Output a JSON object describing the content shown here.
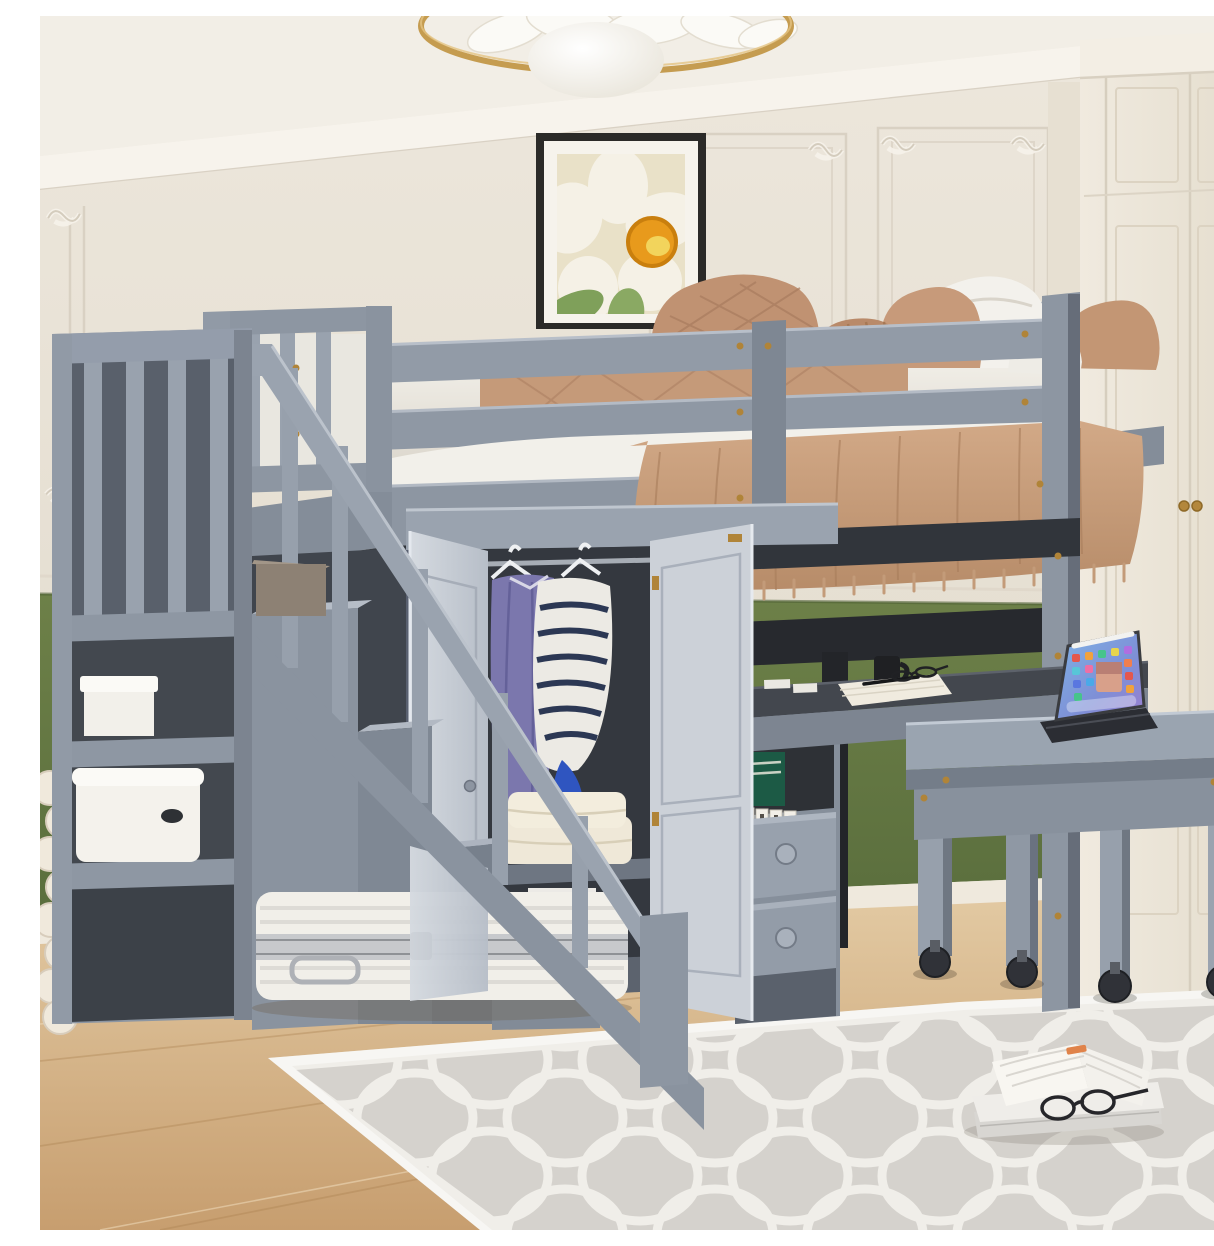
{
  "image": {
    "kind": "furniture product photograph",
    "subject": "Gray loft bed with storage staircase, open wardrobe, shelves, drawers, built-in desk and rolling desk in a bedroom",
    "setting": "bedroom with cream paneled walls, olive-green wainscot, white built-in closet, gold ring chandelier, light oak floor and gray quatrefoil trellis rug"
  },
  "palette": {
    "ceiling": "#f2eee6",
    "wall_cream": "#e9e3d7",
    "panel_molding": "#d9d1c3",
    "wainscot_green": "#64783f",
    "closet_cream": "#ece6da",
    "floor_wood": "#d7b98f",
    "rug_gray": "#d5d2cd",
    "rug_white": "#f0eee9",
    "bed_gray": "#8d96a2",
    "bed_gray_light": "#c9ced6",
    "bed_gray_dark": "#4a505a",
    "desk_top_dark": "#43474e",
    "metal_black": "#26282c",
    "brass": "#b08438",
    "bedding_white": "#f2f0ea",
    "pillow_tan": "#c49a7a",
    "throw_tan": "#c9a083",
    "art_flower_orange": "#e89a1c",
    "leaf_green": "#7fa05a",
    "garment_purple": "#7b77ad",
    "sweater_stripe_navy": "#2c3854",
    "sweater_cuff_blue": "#2f55c0",
    "hatbox_beige": "#e3d7ae",
    "tablet_screen_blue": "#6d9ddf"
  },
  "objects": {
    "ceiling_lamp": {
      "parts": [
        "gold ring",
        "white petals",
        "white globe"
      ]
    },
    "wall_art": {
      "desc": "black framed painting of a white flower with orange center and green leaves"
    },
    "loft_bed": {
      "desc": "gray wood loft bed with double guardrails, slat panels and posts",
      "bedding": [
        "white sheets",
        "tan quilted pillows",
        "white pillows",
        "fringed camel throw"
      ]
    },
    "staircase": {
      "desc": "storage staircase with handrail, balusters, side shelves",
      "items": [
        "white gift box",
        "white storage bin",
        "taupe box on step",
        "white suitcase on floor"
      ]
    },
    "wardrobe": {
      "desc": "open double-door wardrobe under bed",
      "items": [
        "purple top on hanger",
        "navy striped sweater on hanger",
        "folded cream blankets",
        "white box",
        "round beige hatbox",
        "gray box"
      ]
    },
    "shelf_column": {
      "desc": "cubby with green box and letter tiles, two drawers with round knobs"
    },
    "built_in_desk": {
      "items": [
        "black mug on white coaster",
        "white blocks",
        "cream notebook with black pen",
        "black reading glasses"
      ]
    },
    "rolling_desk": {
      "desc": "gray desk on black casters",
      "items": [
        "tablet with keyboard, colorful app screen and white stylus"
      ]
    },
    "floor_items": [
      "open book on closed book",
      "black reading glasses",
      "cream wooden bead garland"
    ]
  }
}
